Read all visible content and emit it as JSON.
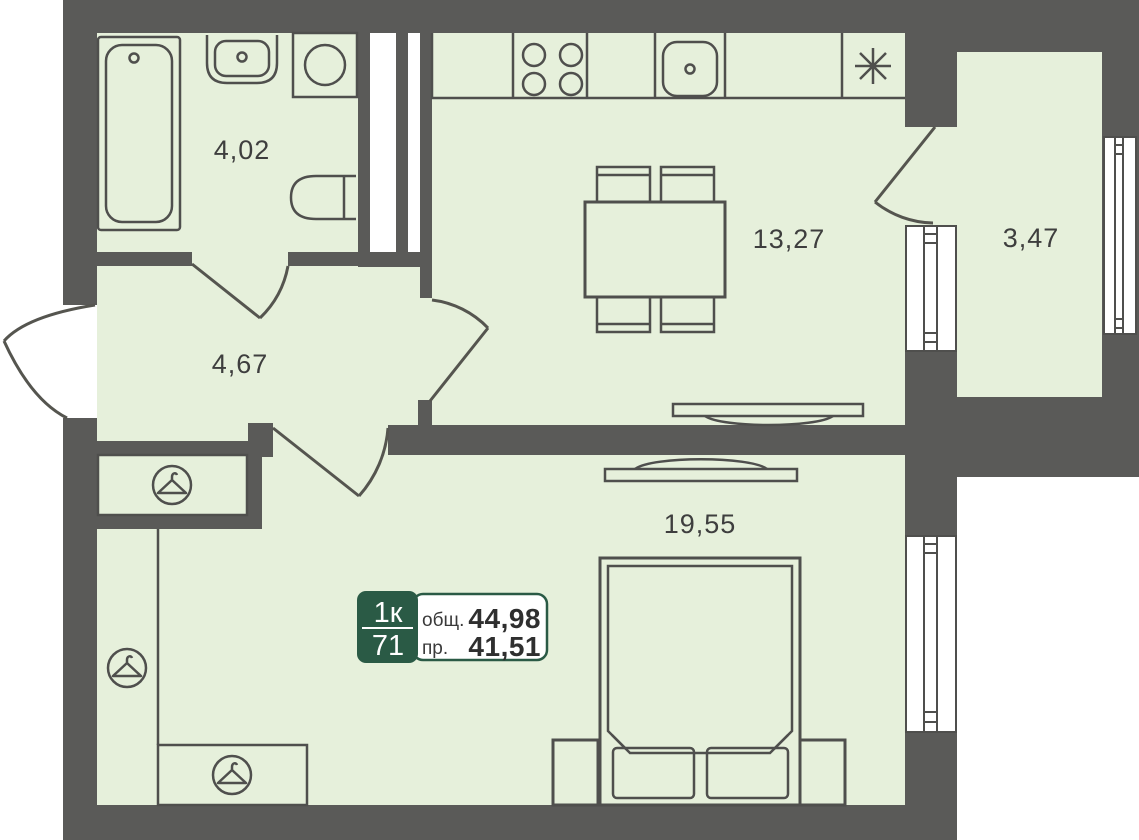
{
  "plan": {
    "rooms": [
      {
        "id": "bathroom",
        "area": "4,02"
      },
      {
        "id": "hallway",
        "area": "4,67"
      },
      {
        "id": "kitchen",
        "area": "13,27"
      },
      {
        "id": "balcony",
        "area": "3,47"
      },
      {
        "id": "living-room",
        "area": "19,55"
      }
    ],
    "badge": {
      "rooms_count": "1к",
      "plan_number": "71",
      "total_label": "общ.",
      "total_area": "44,98",
      "living_label": "пр.",
      "living_area": "41,51"
    },
    "colors": {
      "floor": "#e6f0db",
      "wall": "#5a5a58",
      "outline": "#4f4f4d",
      "badge_green": "#2a5a45",
      "label_text": "#3e3e3e"
    }
  }
}
